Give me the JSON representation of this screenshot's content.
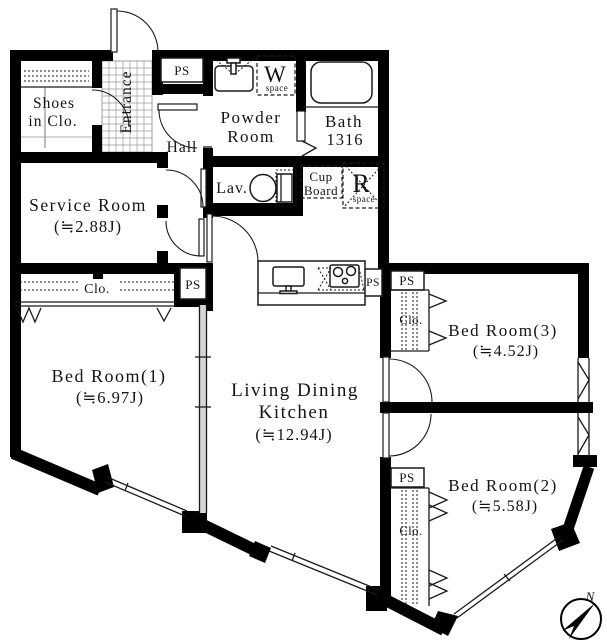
{
  "plan_title": "apartment floor plan",
  "rooms": {
    "shoes": {
      "line1": "Shoes",
      "line2": "in Clo."
    },
    "entrance": {
      "label": "Entrance"
    },
    "hall": {
      "label": "Hall"
    },
    "powder": {
      "line1": "Powder",
      "line2": "Room"
    },
    "bath": {
      "name": "Bath",
      "size": "1316"
    },
    "lav": {
      "label": "Lav."
    },
    "cupboard": {
      "line1": "Cup",
      "line2": "Board"
    },
    "wspace": {
      "letter": "W",
      "sub": "space"
    },
    "rspace": {
      "letter": "R",
      "sub": "space"
    },
    "service": {
      "name": "Service Room",
      "area": "(≒2.88J)"
    },
    "ldk": {
      "line1": "Living Dining",
      "line2": "Kitchen",
      "area": "(≒12.94J)"
    },
    "bed1": {
      "name": "Bed Room(1)",
      "area": "(≒6.97J)"
    },
    "bed2": {
      "name": "Bed Room(2)",
      "area": "(≒5.58J)"
    },
    "bed3": {
      "name": "Bed Room(3)",
      "area": "(≒4.52J)"
    }
  },
  "labels": {
    "ps": "PS",
    "clo": "Clo.",
    "north": "N"
  },
  "colors": {
    "line": "#000000",
    "background": "#ffffff"
  }
}
